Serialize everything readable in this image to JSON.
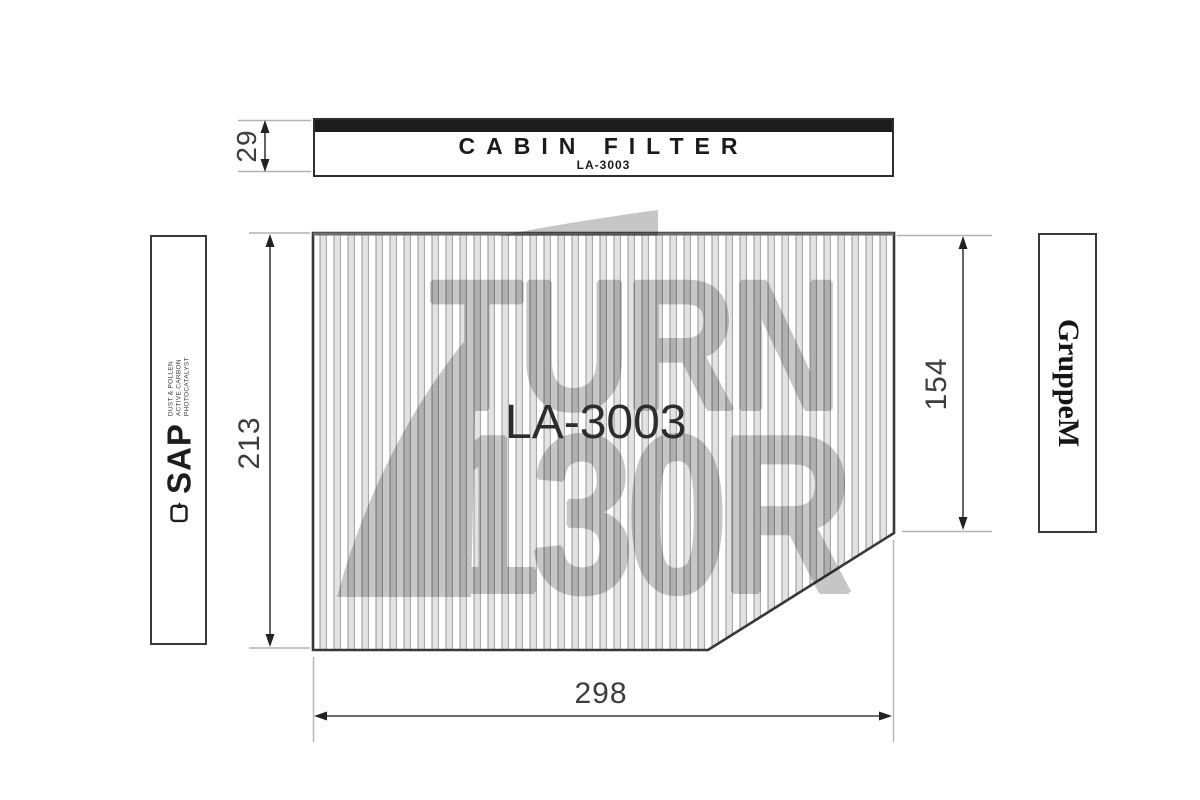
{
  "title_plate": {
    "title": "CABIN FILTER",
    "part_number": "LA-3003"
  },
  "filter": {
    "part_number": "LA-3003"
  },
  "dimensions": {
    "plate_height": "29",
    "filter_left_height": "213",
    "filter_right_height": "154",
    "filter_width": "298"
  },
  "left_label": {
    "brand": "SAP",
    "lines": [
      "DUST & POLLEN",
      "ACTIVE CARBON",
      "PHOTOCATALYST"
    ]
  },
  "right_label": {
    "brand": "GruppeM"
  },
  "watermark": {
    "line1": "TURN",
    "line2": "130R"
  },
  "colors": {
    "plate_band": "#1c1c1c",
    "outline": "#383838",
    "pleat_line": "#a9a9a9",
    "pleat_fill": "#e3e3e3",
    "dimension_line": "#3c3c3c",
    "extension_line": "#b3b3b3",
    "watermark": "#c6c6c6",
    "text": "#2d2d2d"
  }
}
